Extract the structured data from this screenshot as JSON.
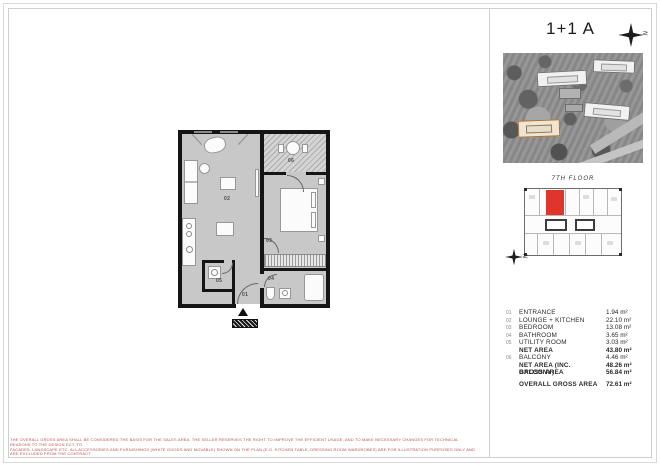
{
  "sheet": {
    "title": "1+1 A",
    "compass_letter": "N",
    "floor_label": "7TH FLOOR",
    "entrance_arrow": "▲"
  },
  "plan": {
    "room_labels": [
      "01",
      "02",
      "03",
      "04",
      "05",
      "06"
    ]
  },
  "area_table": {
    "rows": [
      {
        "no": "01",
        "label": "ENTRANCE",
        "value": "1.94 m²"
      },
      {
        "no": "02",
        "label": "LOUNGE + KITCHEN",
        "value": "22.10 m²"
      },
      {
        "no": "03",
        "label": "BEDROOM",
        "value": "13.08 m²"
      },
      {
        "no": "04",
        "label": "BATHROOM",
        "value": "3.65 m²"
      },
      {
        "no": "05",
        "label": "UTILITY ROOM",
        "value": "3.03 m²"
      },
      {
        "no": "",
        "label": "NET AREA",
        "value": "43.80 m²"
      },
      {
        "no": "06",
        "label": "BALCONY",
        "value": "4.46 m²"
      },
      {
        "no": "",
        "label": "NET AREA (INC. BALCONY)",
        "value": "48.26 m²"
      },
      {
        "no": "",
        "label": "GROSS AREA",
        "value": "56.84 m²"
      },
      {
        "no": "",
        "label": "OVERALL GROSS AREA",
        "value": "72.61 m²"
      }
    ]
  },
  "disclaimer": {
    "line1": "THE OVERALL GROSS AREA SHALL BE CONSIDERED THE BASIS FOR THE SALES AREA. THE SELLER RESERVES THE RIGHT TO IMPROVE THE EFFICIENT USAGE, AND TO MAKE NECESSARY CHANGES FOR TECHNICAL REASONS TO THE DESIGN ECT. TO",
    "line2": "FACADES, LANDSCAPE ETC. ALL ACCESSORIES AND FURNISHINGS (WHITE GOODS AND MOVABLE) SHOWN ON THE PLAN (E.G. KITCHEN TABLE, DRESSING ROOM WARDROBES) ARE FOR ILLUSTRATION PURPOSES ONLY AND ARE EXCLUDED FROM THE CONTRACT"
  },
  "colors": {
    "highlight_red": "#e0352b",
    "floor_gray": "#c8c8c8",
    "wall_black": "#151515",
    "disclaimer_red": "#b25450"
  }
}
